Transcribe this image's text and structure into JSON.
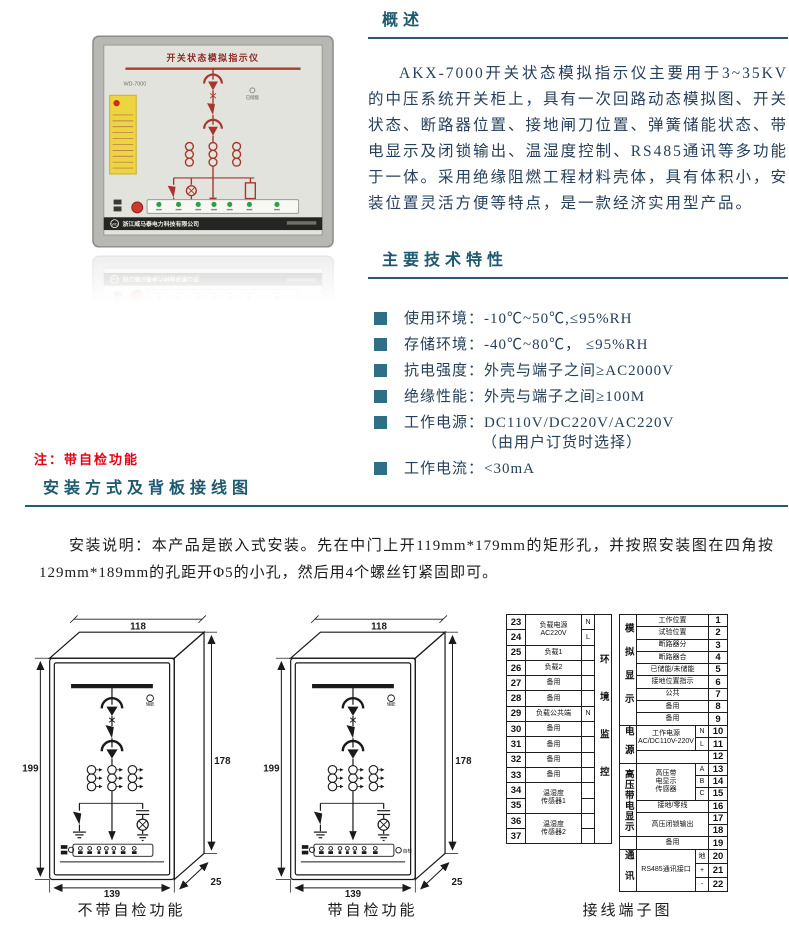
{
  "overview": {
    "title": "概述",
    "paragraph": "AKX-7000开关状态模拟指示仪主要用于3~35KV的中压系统开关柜上，具有一次回路动态模拟图、开关状态、断路器位置、接地闸刀位置、弹簧储能状态、带电显示及闭锁输出、温湿度控制、RS485通讯等多功能于一体。采用绝缘阻燃工程材料壳体，具有体积小，安装位置灵活方便等特点，是一款经济实用型产品。"
  },
  "features": {
    "title": "主要技术特性",
    "items": [
      {
        "text": "使用环境：-10℃~50℃,≤95%RH"
      },
      {
        "text": "存储环境：-40℃~80℃， ≤95%RH"
      },
      {
        "text": "抗电强度：外壳与端子之间≥AC2000V"
      },
      {
        "text": "绝缘性能：外壳与端子之间≥100M"
      },
      {
        "text": "工作电源：DC110V/DC220V/AC220V",
        "sub": "（由用户订货时选择）"
      },
      {
        "text": "工作电流：<30mA"
      }
    ]
  },
  "note": "注：带自检功能",
  "install": {
    "title": "安装方式及背板接线图",
    "paragraph": "安装说明：本产品是嵌入式安装。先在中门上开119mm*179mm的矩形孔，并按照安装图在四角按129mm*189mm的孔距开Φ5的小孔，然后用4个螺丝钉紧固即可。"
  },
  "photo": {
    "title": "开关状态模拟指示仪",
    "model": "WD-7000",
    "indicator": "已储能",
    "logo": "WD",
    "company": "浙江威马泰电力科技有限公司"
  },
  "drawings": {
    "dim_width": "118",
    "dim_height": "199",
    "dim_panel_height": "178",
    "dim_bottom_width": "139",
    "dim_depth": "25",
    "energy_label": "储能",
    "selfcheck_label": "自检",
    "caption_no_selfcheck": "不带自检功能",
    "caption_selfcheck": "带自检功能"
  },
  "terminal": {
    "caption": "接线端子图",
    "left": {
      "group": "环境监控",
      "rows": [
        {
          "no": "23",
          "label": "负载电源\nAC220V",
          "sub": "N"
        },
        {
          "no": "24",
          "sub": "L"
        },
        {
          "no": "25",
          "label": "负载1",
          "sub": ""
        },
        {
          "no": "26",
          "label": "负载2",
          "sub": ""
        },
        {
          "no": "27",
          "label": "备用",
          "sub": ""
        },
        {
          "no": "28",
          "label": "备用",
          "sub": ""
        },
        {
          "no": "29",
          "label": "负载公共端",
          "sub": "N"
        },
        {
          "no": "30",
          "label": "备用",
          "sub": ""
        },
        {
          "no": "31",
          "label": "备用",
          "sub": ""
        },
        {
          "no": "32",
          "label": "备用",
          "sub": ""
        },
        {
          "no": "33",
          "label": "备用",
          "sub": ""
        },
        {
          "no": "34",
          "label": "温湿度\n传感器1",
          "sub": ""
        },
        {
          "no": "35",
          "sub": ""
        },
        {
          "no": "36",
          "label": "温湿度\n传感器2",
          "sub": ""
        },
        {
          "no": "37",
          "sub": ""
        }
      ]
    },
    "right": {
      "groups": [
        "模拟显示",
        "电源",
        "高压带电显示",
        "通讯"
      ],
      "rows": [
        {
          "no": "1",
          "label": "工作位置"
        },
        {
          "no": "2",
          "label": "试验位置"
        },
        {
          "no": "3",
          "label": "断路器分"
        },
        {
          "no": "4",
          "label": "断路器合"
        },
        {
          "no": "5",
          "label": "已储能/未储能"
        },
        {
          "no": "6",
          "label": "接地位置指示"
        },
        {
          "no": "7",
          "label": "公共"
        },
        {
          "no": "8",
          "label": "备用"
        },
        {
          "no": "9",
          "label": "备用"
        },
        {
          "no": "10",
          "label": "工作电源\nAC/DC110V-220V",
          "sub": "N"
        },
        {
          "no": "11",
          "sub": "L"
        },
        {
          "no": "12",
          "label": ""
        },
        {
          "no": "13",
          "label": "高压带\n电显示\n传感器",
          "sub": "A"
        },
        {
          "no": "14",
          "sub": "B"
        },
        {
          "no": "15",
          "sub": "C"
        },
        {
          "no": "16",
          "label": "接地/零线"
        },
        {
          "no": "17",
          "label": "高压闭锁输出"
        },
        {
          "no": "18"
        },
        {
          "no": "19",
          "label": "备用"
        },
        {
          "no": "20",
          "label": "RS485通讯接口",
          "sub": "地"
        },
        {
          "no": "21",
          "sub": "+"
        },
        {
          "no": "22",
          "sub": "-"
        }
      ]
    }
  },
  "colors": {
    "heading": "#1d5a70",
    "bullet": "#2e6f85",
    "note_red": "#e60014",
    "body_text": "#27405c",
    "mimic_red": "#a8362c"
  }
}
